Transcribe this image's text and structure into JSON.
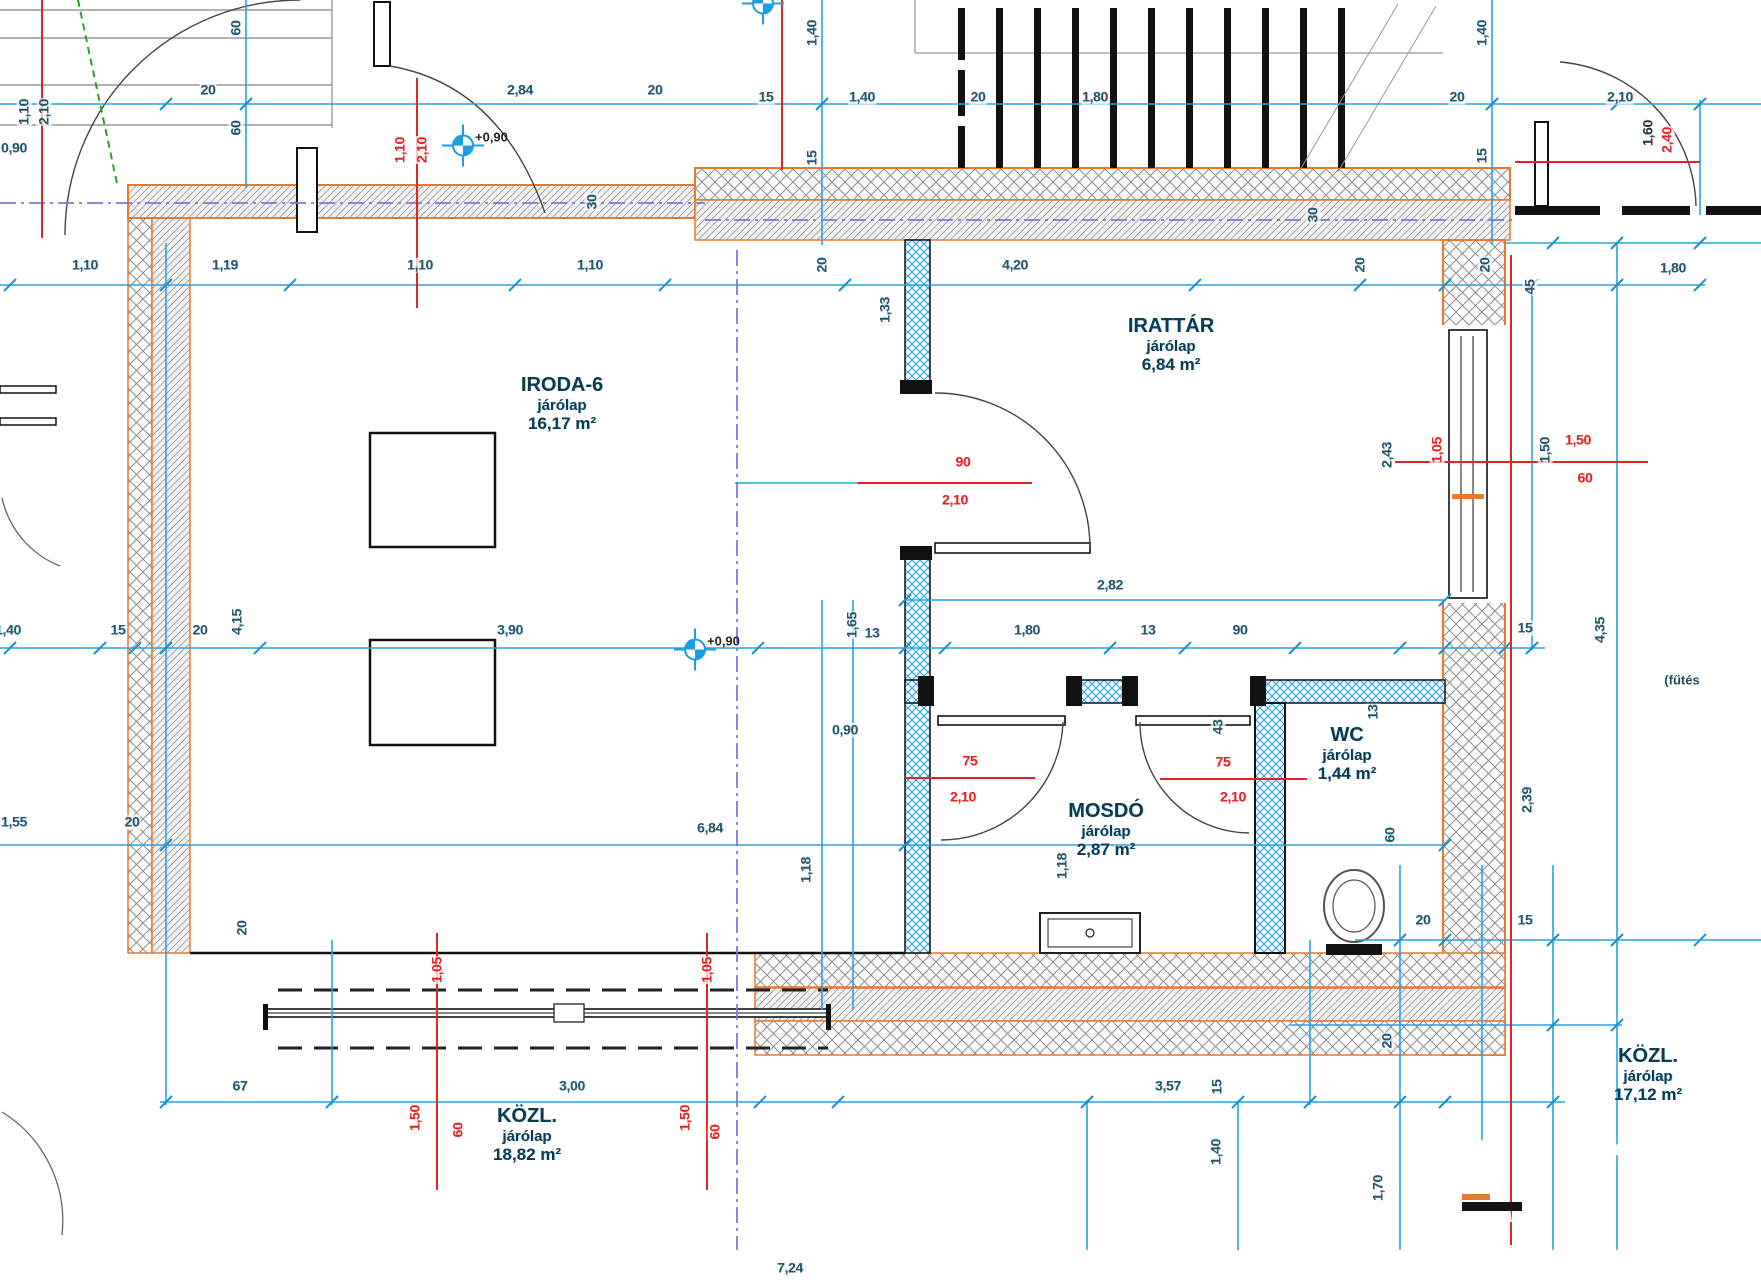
{
  "drawing_type": "architectural floor plan (CAD)",
  "colors": {
    "dimension_blue": "#29a3dc",
    "dimension_text": "#2b5566",
    "red_marks": "#e02525",
    "wall_orange": "#e87a2e",
    "centerline_violet": "#7b7bd9",
    "green_dashed": "#2aa02a",
    "room_text": "#0f3a4e"
  },
  "rooms": [
    {
      "name": "IRODA-6",
      "finish": "járólap",
      "area": "16,17 m²",
      "x": 562,
      "y": 404
    },
    {
      "name": "IRATTÁR",
      "finish": "járólap",
      "area": "6,84 m²",
      "x": 1171,
      "y": 345
    },
    {
      "name": "MOSDÓ",
      "finish": "járólap",
      "area": "2,87 m²",
      "x": 1106,
      "y": 830
    },
    {
      "name": "WC",
      "finish": "járólap",
      "area": "1,44 m²",
      "x": 1347,
      "y": 754
    },
    {
      "name": "KÖZL.",
      "finish": "járólap",
      "area": "18,82 m²",
      "x": 527,
      "y": 1135
    },
    {
      "name": "KÖZL.",
      "finish": "járólap",
      "area": "17,12 m²",
      "x": 1648,
      "y": 1075
    }
  ],
  "levels": [
    {
      "label": "+0,90",
      "x": 463,
      "y": 148
    },
    {
      "label": "+0,90",
      "x": 695,
      "y": 652
    },
    {
      "label": "",
      "x": 763,
      "y": 6
    }
  ],
  "annotations": [
    {
      "text": "(fűtés",
      "x": 1682,
      "y": 680
    }
  ],
  "dimensions": [
    {
      "t": "20",
      "x": 208,
      "y": 90
    },
    {
      "t": "2,84",
      "x": 520,
      "y": 90
    },
    {
      "t": "20",
      "x": 655,
      "y": 90
    },
    {
      "t": "15",
      "x": 766,
      "y": 97
    },
    {
      "t": "1,40",
      "x": 862,
      "y": 97
    },
    {
      "t": "20",
      "x": 978,
      "y": 97
    },
    {
      "t": "1,80",
      "x": 1095,
      "y": 97
    },
    {
      "t": "20",
      "x": 1457,
      "y": 97
    },
    {
      "t": "2,10",
      "x": 1620,
      "y": 97
    },
    {
      "t": "0,90",
      "x": 14,
      "y": 148
    },
    {
      "t": "1,10",
      "x": 85,
      "y": 265
    },
    {
      "t": "1,19",
      "x": 225,
      "y": 265
    },
    {
      "t": "1,10",
      "x": 420,
      "y": 265
    },
    {
      "t": "1,10",
      "x": 590,
      "y": 265
    },
    {
      "t": "4,20",
      "x": 1015,
      "y": 265
    },
    {
      "t": "1,80",
      "x": 1673,
      "y": 268
    },
    {
      "t": "1,40",
      "x": 8,
      "y": 630
    },
    {
      "t": "15",
      "x": 118,
      "y": 630
    },
    {
      "t": "20",
      "x": 200,
      "y": 630
    },
    {
      "t": "3,90",
      "x": 510,
      "y": 630
    },
    {
      "t": "13",
      "x": 872,
      "y": 633
    },
    {
      "t": "1,80",
      "x": 1027,
      "y": 630
    },
    {
      "t": "13",
      "x": 1148,
      "y": 630
    },
    {
      "t": "90",
      "x": 1240,
      "y": 630
    },
    {
      "t": "15",
      "x": 1525,
      "y": 628
    },
    {
      "t": "2,82",
      "x": 1110,
      "y": 585
    },
    {
      "t": "0,90",
      "x": 845,
      "y": 730
    },
    {
      "t": "1,55",
      "x": 14,
      "y": 822
    },
    {
      "t": "20",
      "x": 132,
      "y": 822
    },
    {
      "t": "6,84",
      "x": 710,
      "y": 828
    },
    {
      "t": "20",
      "x": 1423,
      "y": 920
    },
    {
      "t": "15",
      "x": 1525,
      "y": 920
    },
    {
      "t": "67",
      "x": 240,
      "y": 1086
    },
    {
      "t": "3,00",
      "x": 572,
      "y": 1086
    },
    {
      "t": "3,57",
      "x": 1168,
      "y": 1086
    },
    {
      "t": "7,24",
      "x": 790,
      "y": 1268
    },
    {
      "t": "60",
      "x": 236,
      "y": 28,
      "r": 1
    },
    {
      "t": "60",
      "x": 236,
      "y": 128,
      "r": 1
    },
    {
      "t": "1,40",
      "x": 812,
      "y": 33,
      "r": 1
    },
    {
      "t": "15",
      "x": 812,
      "y": 158,
      "r": 1
    },
    {
      "t": "1,40",
      "x": 1482,
      "y": 33,
      "r": 1
    },
    {
      "t": "15",
      "x": 1482,
      "y": 156,
      "r": 1
    },
    {
      "t": "1,10",
      "x": 24,
      "y": 112,
      "r": 1
    },
    {
      "t": "2,10",
      "x": 44,
      "y": 112,
      "r": 1
    },
    {
      "t": "30",
      "x": 592,
      "y": 202,
      "r": 1
    },
    {
      "t": "30",
      "x": 1313,
      "y": 215,
      "r": 1
    },
    {
      "t": "20",
      "x": 822,
      "y": 265,
      "r": 1
    },
    {
      "t": "20",
      "x": 1360,
      "y": 265,
      "r": 1
    },
    {
      "t": "20",
      "x": 1485,
      "y": 265,
      "r": 1
    },
    {
      "t": "45",
      "x": 1530,
      "y": 287,
      "r": 1
    },
    {
      "t": "1,33",
      "x": 885,
      "y": 310,
      "r": 1
    },
    {
      "t": "4,15",
      "x": 237,
      "y": 622,
      "r": 1
    },
    {
      "t": "1,65",
      "x": 852,
      "y": 625,
      "r": 1
    },
    {
      "t": "2,43",
      "x": 1387,
      "y": 455,
      "r": 1
    },
    {
      "t": "1,50",
      "x": 1545,
      "y": 450,
      "r": 1
    },
    {
      "t": "4,35",
      "x": 1600,
      "y": 630,
      "r": 1
    },
    {
      "t": "13",
      "x": 1373,
      "y": 712,
      "r": 1
    },
    {
      "t": "43",
      "x": 1218,
      "y": 727,
      "r": 1
    },
    {
      "t": "2,39",
      "x": 1527,
      "y": 800,
      "r": 1
    },
    {
      "t": "60",
      "x": 1390,
      "y": 835,
      "r": 1
    },
    {
      "t": "1,18",
      "x": 806,
      "y": 870,
      "r": 1
    },
    {
      "t": "1,18",
      "x": 1062,
      "y": 866,
      "r": 1
    },
    {
      "t": "20",
      "x": 242,
      "y": 928,
      "r": 1
    },
    {
      "t": "20",
      "x": 1387,
      "y": 1041,
      "r": 1
    },
    {
      "t": "15",
      "x": 1217,
      "y": 1087,
      "r": 1
    },
    {
      "t": "1,40",
      "x": 1216,
      "y": 1152,
      "r": 1
    },
    {
      "t": "1,70",
      "x": 1378,
      "y": 1188,
      "r": 1
    },
    {
      "t": "90",
      "x": 963,
      "y": 462,
      "c": "r"
    },
    {
      "t": "2,10",
      "x": 955,
      "y": 500,
      "c": "r"
    },
    {
      "t": "75",
      "x": 970,
      "y": 761,
      "c": "r"
    },
    {
      "t": "2,10",
      "x": 963,
      "y": 797,
      "c": "r"
    },
    {
      "t": "75",
      "x": 1223,
      "y": 762,
      "c": "r"
    },
    {
      "t": "2,10",
      "x": 1233,
      "y": 797,
      "c": "r"
    },
    {
      "t": "1,50",
      "x": 1578,
      "y": 440,
      "c": "r"
    },
    {
      "t": "60",
      "x": 1585,
      "y": 478,
      "c": "r"
    },
    {
      "t": "1,10",
      "x": 400,
      "y": 150,
      "r": 1,
      "c": "r"
    },
    {
      "t": "2,10",
      "x": 422,
      "y": 150,
      "r": 1,
      "c": "r"
    },
    {
      "t": "1,05",
      "x": 1437,
      "y": 450,
      "r": 1,
      "c": "r"
    },
    {
      "t": "2,40",
      "x": 1667,
      "y": 140,
      "r": 1,
      "c": "r"
    },
    {
      "t": "1,60",
      "x": 1648,
      "y": 133,
      "r": 1,
      "c": "d"
    },
    {
      "t": "1,05",
      "x": 437,
      "y": 970,
      "r": 1,
      "c": "r"
    },
    {
      "t": "1,05",
      "x": 707,
      "y": 970,
      "r": 1,
      "c": "r"
    },
    {
      "t": "1,50",
      "x": 415,
      "y": 1118,
      "r": 1,
      "c": "r"
    },
    {
      "t": "60",
      "x": 458,
      "y": 1130,
      "r": 1,
      "c": "r"
    },
    {
      "t": "1,50",
      "x": 685,
      "y": 1118,
      "r": 1,
      "c": "r"
    },
    {
      "t": "60",
      "x": 715,
      "y": 1132,
      "r": 1,
      "c": "r"
    }
  ]
}
